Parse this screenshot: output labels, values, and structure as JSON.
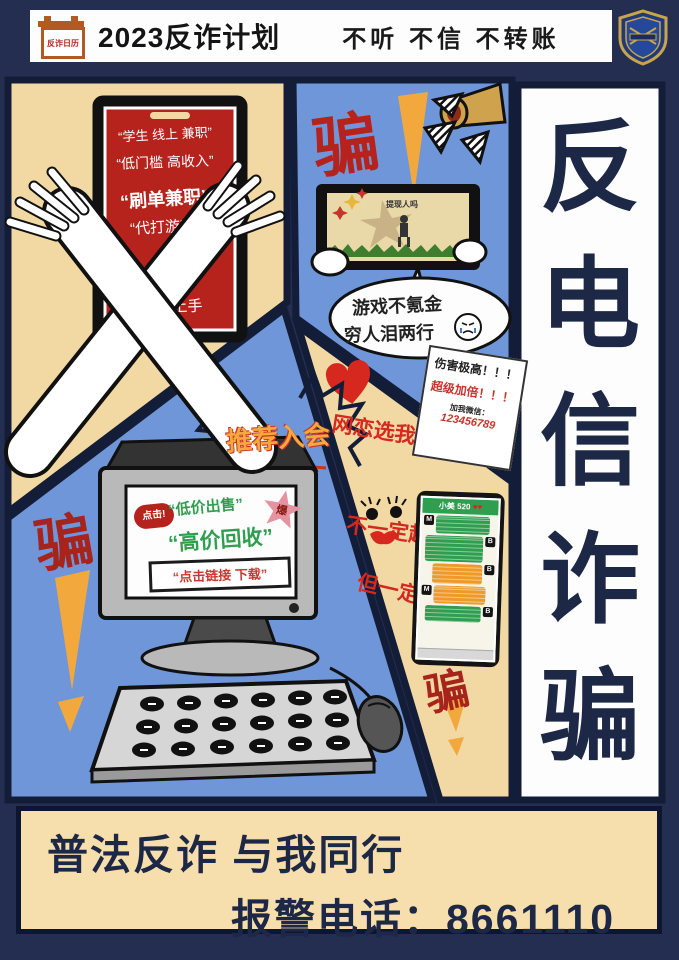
{
  "header": {
    "logo_text": "反诈日历",
    "title": "2023反诈计划",
    "slogan": "不听 不信 不转账",
    "badge_icon": "police-shield"
  },
  "panel_job_scam": {
    "phone_lines": [
      "“学生 线上 兼职”",
      "“低门槛 高收入”",
      "“刷单兼职”",
      "“代打游戏”",
      "简单易上手"
    ]
  },
  "panel_game_scam": {
    "pian": "骗",
    "tablet_caption": "提现人吗",
    "bubble_line1": "游戏不氪金",
    "bubble_line2": "穷人泪两行",
    "note_line1": "伤害极高！！！",
    "note_line2": "超级加倍！！！",
    "note_line3": "加我微信：",
    "note_line4": "123456789"
  },
  "panel_trade_scam": {
    "burst": "推荐入会",
    "click_badge": "点击!",
    "screen_line1": "“低价出售”",
    "burst_char": "爆",
    "screen_line2": "“高价回收”",
    "screen_line3": "“点击链接 下载”",
    "pian": "骗"
  },
  "panel_romance_scam": {
    "line1": "网恋选我",
    "line2": "不一定超甜",
    "line3": "但一定超会骗",
    "chat_title": "小美 520",
    "chat_hearts": "♥♥",
    "avatar_left": "M",
    "avatar_right": "B",
    "pian": "骗"
  },
  "vertical_banner": {
    "chars": [
      "反",
      "电",
      "信",
      "诈",
      "骗"
    ]
  },
  "bottom_banner": {
    "line1": "普法反诈  与我同行",
    "line2": "报警电话：8661110"
  },
  "icons": {
    "megaphone": "megaphone-shape",
    "heart": "♥",
    "crying_face": "crying-face",
    "police_badge": "shield"
  },
  "colors": {
    "poster_bg": "#232e50",
    "panel_cream": "#f2d9a4",
    "panel_blue": "#6f96d8",
    "scam_red": "#b5231c",
    "accent_orange": "#f3a83d",
    "hand_green": "#2f9e4f",
    "navy_text": "#1d2746",
    "chat_green": "#2f9e4f",
    "chat_orange": "#ef9a28"
  }
}
